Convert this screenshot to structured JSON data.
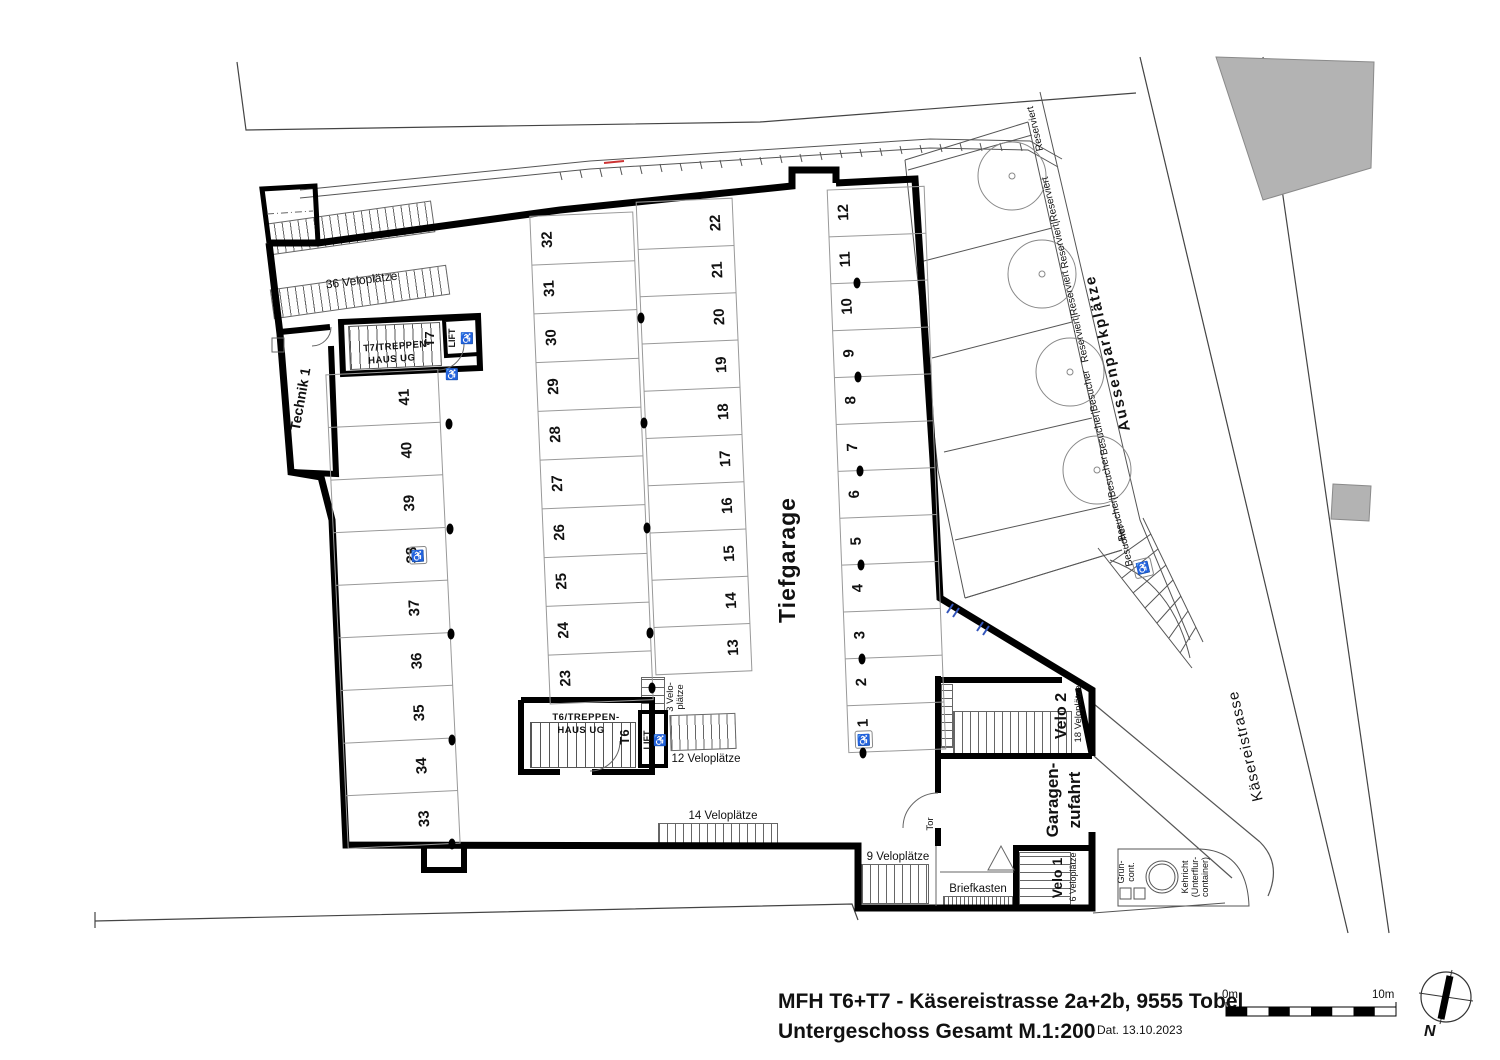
{
  "meta": {
    "title": "MFH T6+T7 - Käsereistrasse 2a+2b, 9555 Tobel",
    "subtitle": "Untergeschoss Gesamt M.1:200",
    "date": "Dat. 13.10.2023"
  },
  "scalebar": {
    "zero": "0m",
    "ten": "10m"
  },
  "compass": {
    "north": "N"
  },
  "garage": {
    "name": "Tiefgarage",
    "col_left": [
      "41",
      "40",
      "39",
      "38",
      "37",
      "36",
      "35",
      "34",
      "33"
    ],
    "col_mid_west": [
      "32",
      "31",
      "30",
      "29",
      "28",
      "27",
      "26",
      "25",
      "24",
      "23"
    ],
    "col_mid_east": [
      "22",
      "21",
      "20",
      "19",
      "18",
      "17",
      "16",
      "15",
      "14",
      "13"
    ],
    "col_east": [
      "12",
      "11",
      "10",
      "9",
      "8",
      "7",
      "6",
      "5",
      "4",
      "3",
      "2",
      "1"
    ]
  },
  "rooms": {
    "technik": "Technik 1",
    "t7_line1": "T7/TREPPEN-",
    "t7_line2": "HAUS UG",
    "t7_short": "T7",
    "t6_line1": "T6/TREPPEN-",
    "t6_line2": "HAUS UG",
    "t6_short": "T6",
    "lift": "LIFT",
    "velo1_name": "Velo 1",
    "velo1_count": "6 Veloplätze",
    "velo2_name": "Velo 2",
    "velo2_count": "18 Veloplätze",
    "zufahrt_line1": "Garagen-",
    "zufahrt_line2": "zufahrt",
    "tor": "Tor",
    "briefkasten": "Briefkasten"
  },
  "velo": {
    "v36": "36 Veloplätze",
    "v14": "14 Veloplätze",
    "v12": "12 Veloplätze",
    "v9": "9 Veloplätze",
    "v3_line1": "3 Velo-",
    "v3_line2": "plätze"
  },
  "outdoor": {
    "title": "Aussenparkplätze",
    "street": "Käsereistrasse",
    "spots": [
      "Reserviert",
      "Reserviert|Reserviert",
      "Reserviert|Reserviert",
      "Besucher|Besucher",
      "Besucher|Besucher",
      "Besucher"
    ]
  },
  "waste": {
    "gruen_line1": "Grün-",
    "gruen_line2": "cont.",
    "kehricht_line1": "Kehricht",
    "kehricht_line2": "(Unterflur-",
    "kehricht_line3": "container)"
  },
  "icons": {
    "wheelchair": "♿"
  },
  "colors": {
    "wall": "#000000",
    "thin_line": "#555555",
    "stall_line": "#999999",
    "neighbor_fill": "#b3b3b3",
    "blue_mark": "#3355bb",
    "red_mark": "#cc3333"
  }
}
